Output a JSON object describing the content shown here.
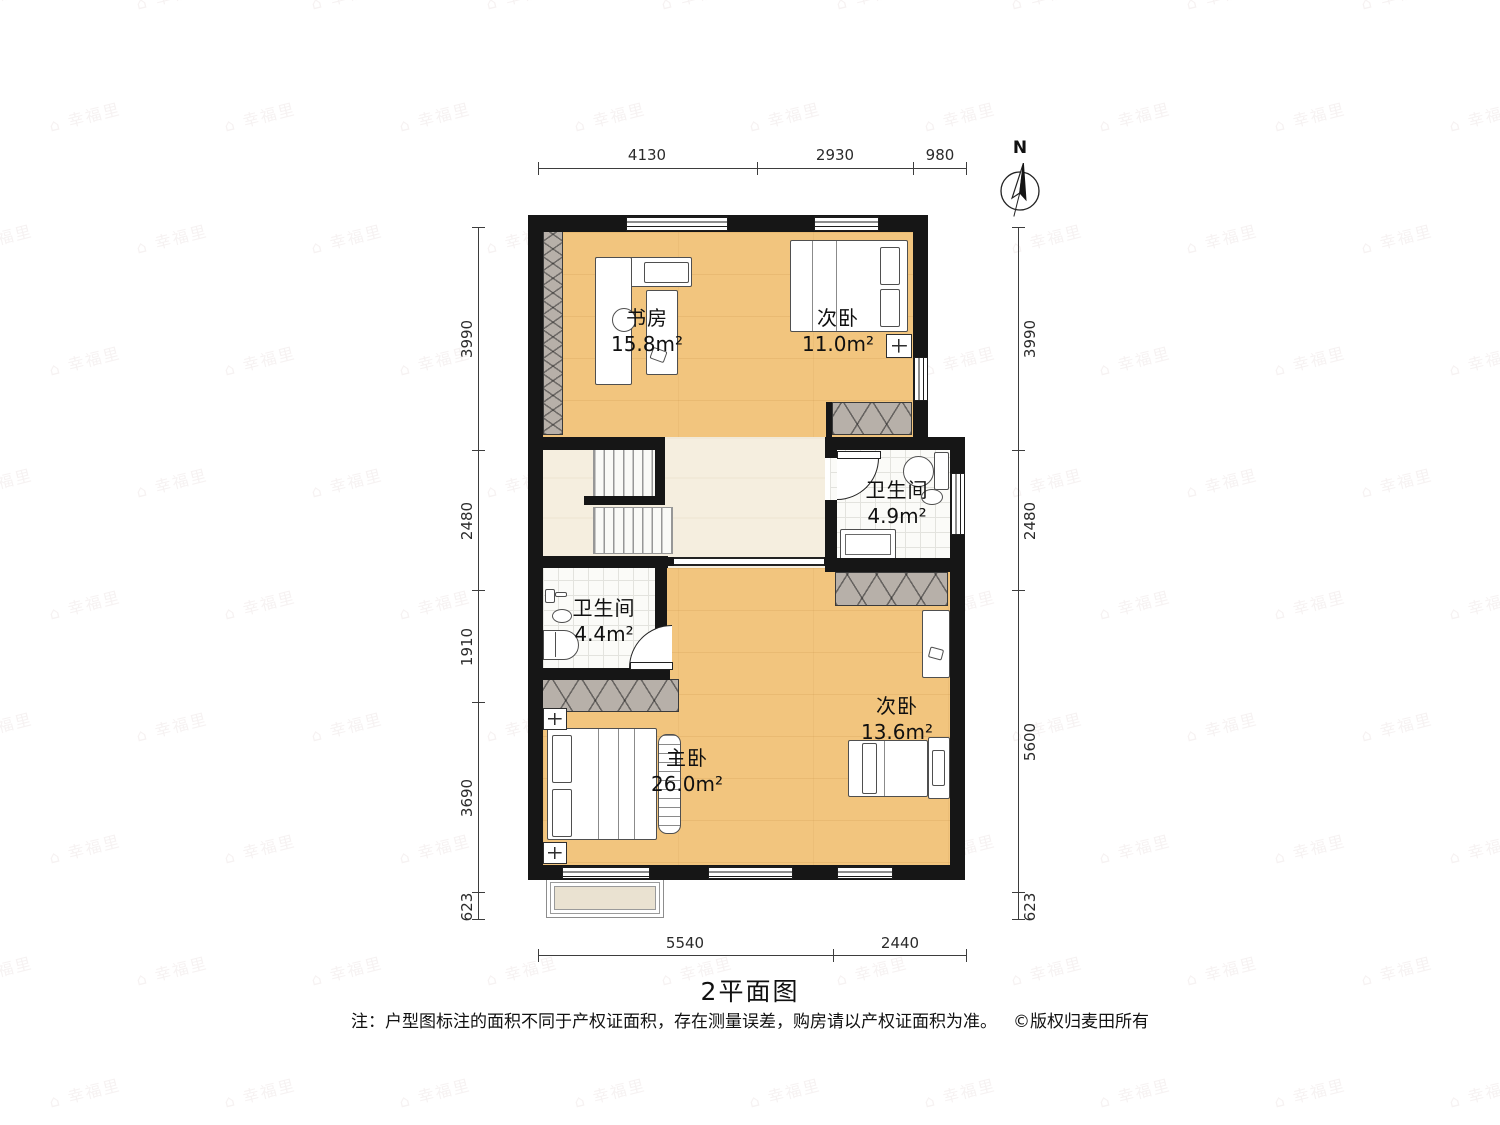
{
  "watermark": {
    "text": "幸福里"
  },
  "compass": {
    "label": "N"
  },
  "dimensions": {
    "top": [
      "4130",
      "2930",
      "980"
    ],
    "bottom": [
      "5540",
      "2440"
    ],
    "left": [
      "3990",
      "2480",
      "1910",
      "3690",
      "623"
    ],
    "right": [
      "3990",
      "2480",
      "5600",
      "623"
    ]
  },
  "rooms": {
    "study": {
      "name": "书房",
      "area": "15.8m²"
    },
    "bedroom_top": {
      "name": "次卧",
      "area": "11.0m²"
    },
    "bath_right": {
      "name": "卫生间",
      "area": "4.9m²"
    },
    "bath_left": {
      "name": "卫生间",
      "area": "4.4m²"
    },
    "master": {
      "name": "主卧",
      "area": "26.0m²"
    },
    "bedroom_bottom": {
      "name": "次卧",
      "area": "13.6m²"
    }
  },
  "footer": {
    "title": "2平面图",
    "note": "注：户型图标注的面积不同于产权证面积，存在测量误差，购房请以产权证面积为准。",
    "copyright": "©版权归麦田所有"
  },
  "colors": {
    "wall": "#161616",
    "wood_floor": "#F2C57E",
    "hall_floor": "#F5EEDF",
    "tile_floor": "#FBFBF8",
    "wardrobe": "#B7B0A9",
    "balcony_floor": "#EAE2D1"
  }
}
